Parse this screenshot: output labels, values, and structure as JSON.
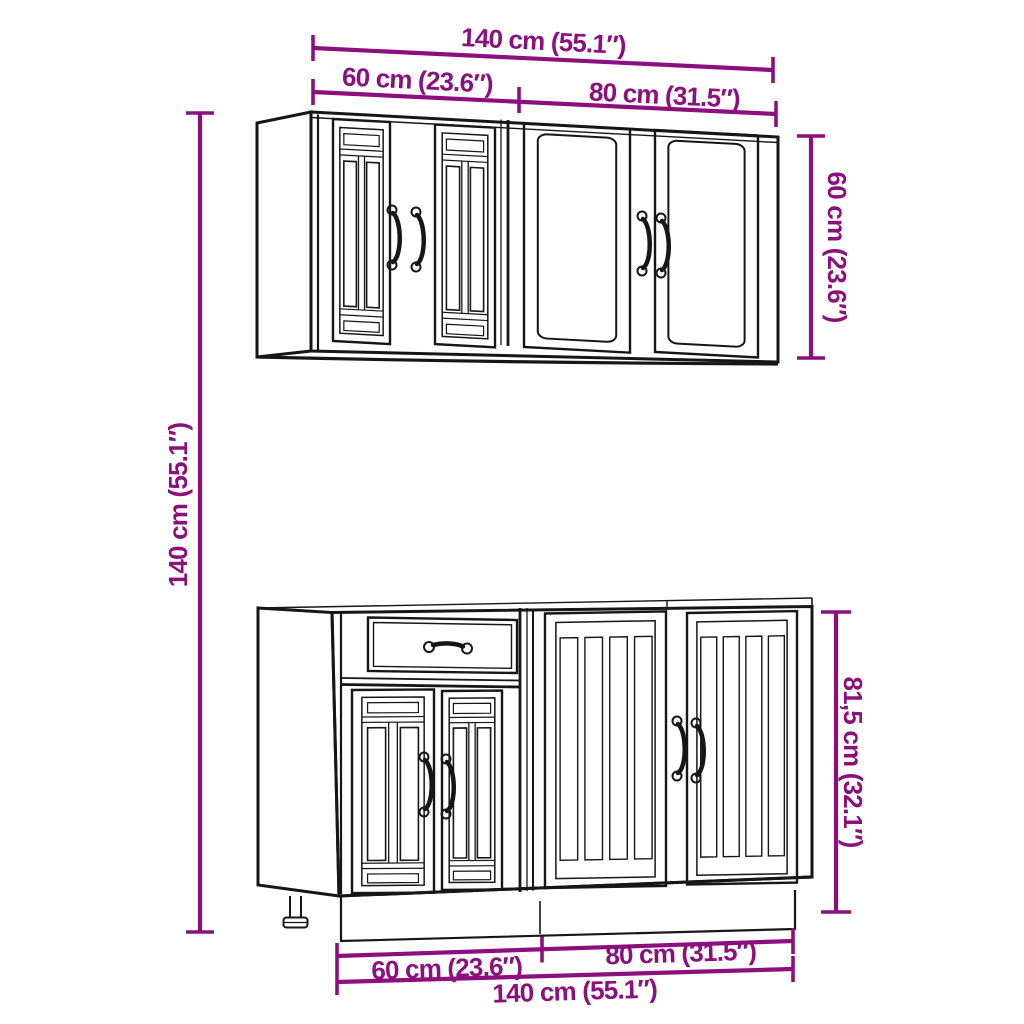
{
  "page": {
    "background": "#ffffff",
    "description": "Dimension diagram of a kitchen cabinet furniture set with one wall cabinet and one base cabinet"
  },
  "colors": {
    "dimension_accent": "#8C0F7E",
    "drawing_outline": "#161616"
  },
  "wall_cabinet": {
    "dims": {
      "total_width": "140 cm (55.1″)",
      "left_unit_width": "60 cm (23.6″)",
      "right_unit_width": "80 cm (31.5″)",
      "height": "60 cm (23.6″)"
    }
  },
  "base_cabinet": {
    "dims": {
      "left_unit_width": "60 cm (23.6″)",
      "right_unit_width": "80 cm (31.5″)",
      "total_width": "140 cm (55.1″)",
      "height": "81,5 cm (32.1″)"
    }
  },
  "overall": {
    "total_height": "140 cm (55.1″)"
  }
}
